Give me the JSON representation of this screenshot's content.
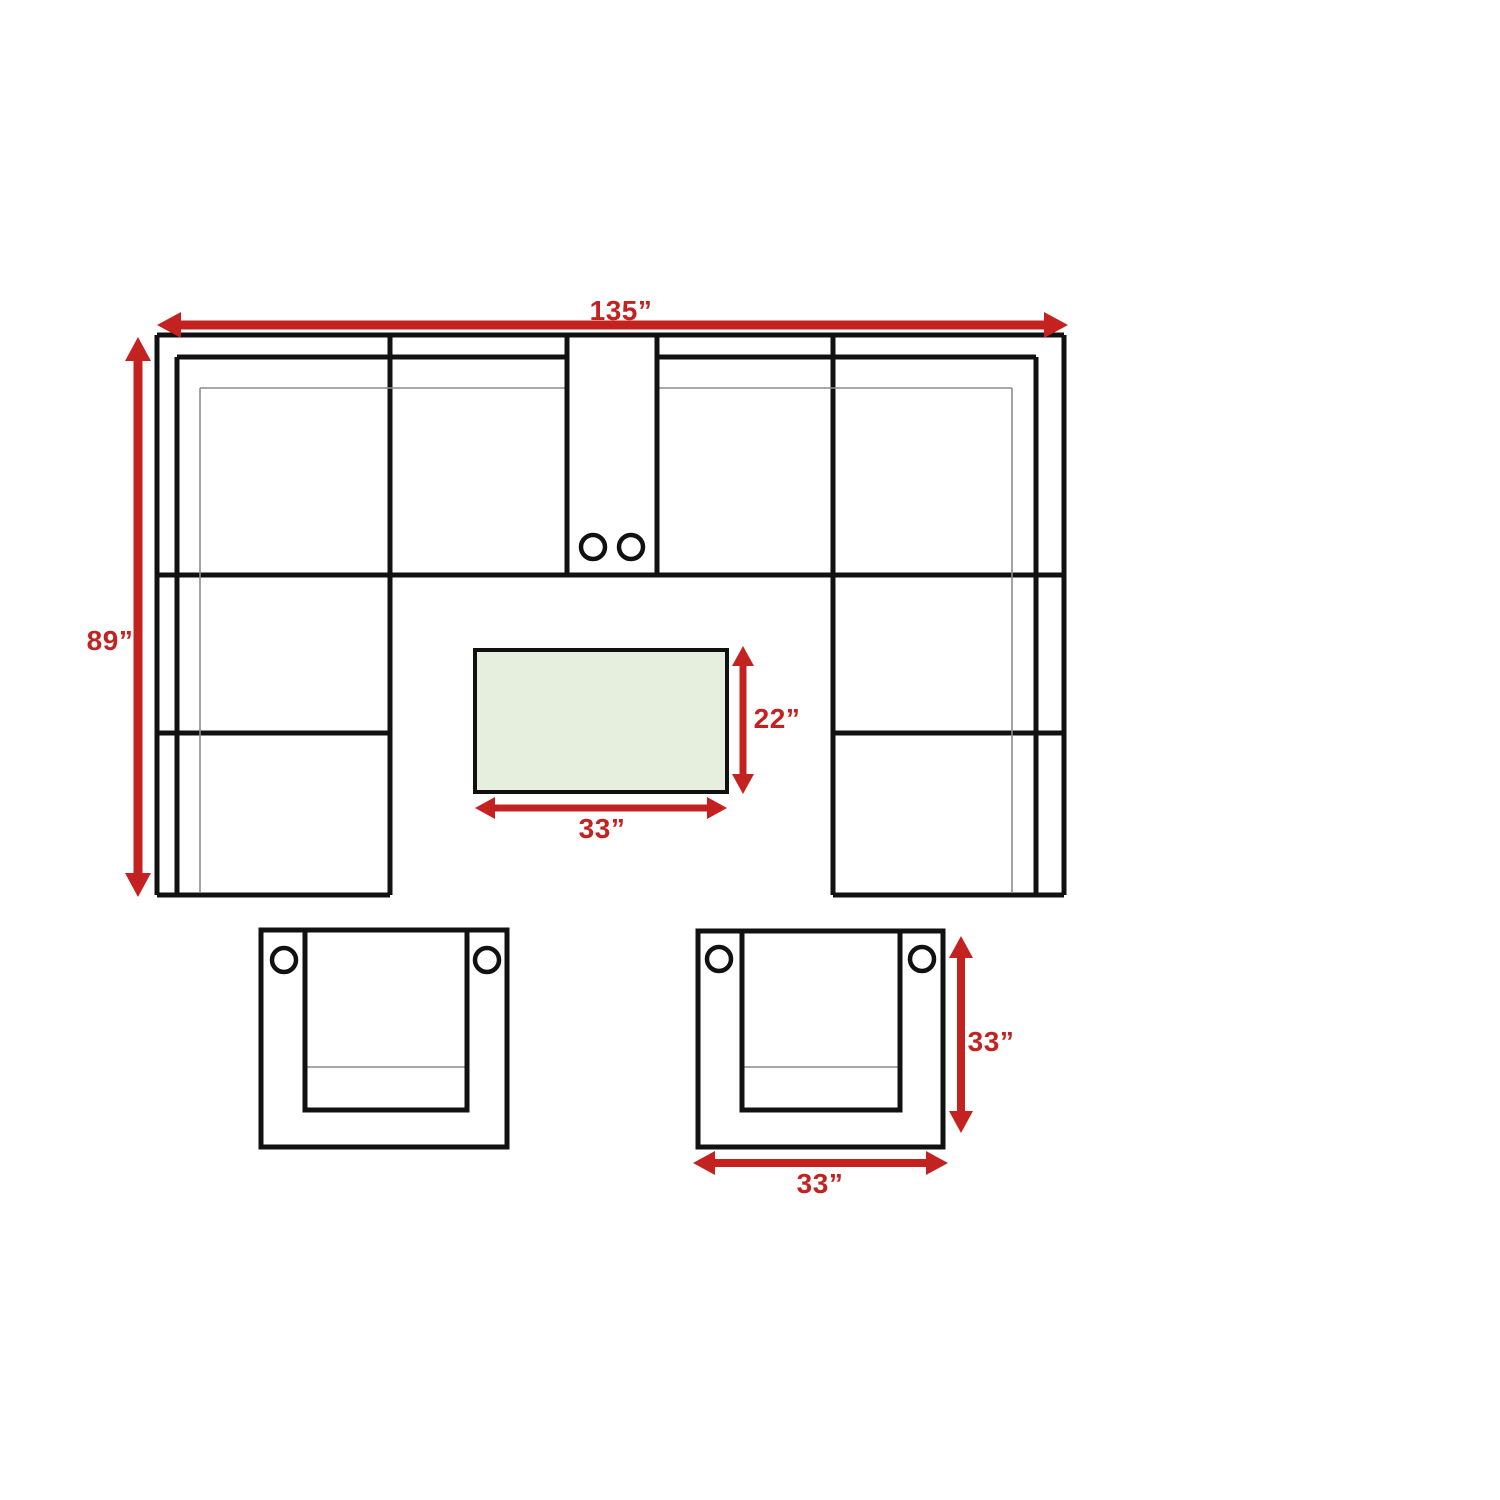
{
  "colors": {
    "dimension_red": "#c42220",
    "table_fill": "#e6eede",
    "line_black": "#111111",
    "thin_gray": "#8c8c8c"
  },
  "sectional": {
    "width_label": "135”",
    "depth_label": "89”"
  },
  "coffee_table": {
    "depth_label": "22”",
    "width_label": "33”"
  },
  "armchair": {
    "depth_label": "33”",
    "width_label": "33”"
  }
}
